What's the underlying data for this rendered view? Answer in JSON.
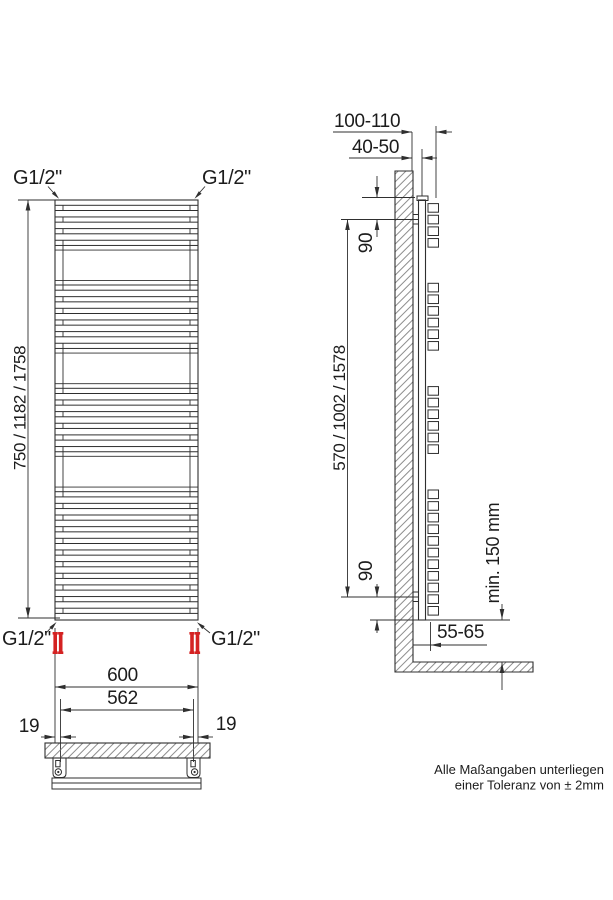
{
  "front_view": {
    "connection_top_left": "G1/2\"",
    "connection_top_right": "G1/2\"",
    "connection_bottom_left": "G1/2\"",
    "connection_bottom_right": "G1/2\"",
    "overall_height": "750 / 1182 / 1758",
    "overall_width": "600",
    "mount_spacing": "562",
    "mount_offset_left": "19",
    "mount_offset_right": "19"
  },
  "side_view": {
    "total_depth": "100-110",
    "wall_distance": "40-50",
    "bracket_top_offset": "90",
    "bracket_bottom_offset": "90",
    "bracket_spacing": "570 / 1002 / 1578",
    "bottom_connection_depth": "55-65",
    "floor_clearance": "min. 150 mm"
  },
  "note": {
    "line1": "Alle Maßangaben unterliegen",
    "line2": "einer Toleranz von ± 2mm"
  },
  "colors": {
    "line": "#2f2f2f",
    "valve": "#d42222",
    "note_text": "#4a4a4a"
  }
}
